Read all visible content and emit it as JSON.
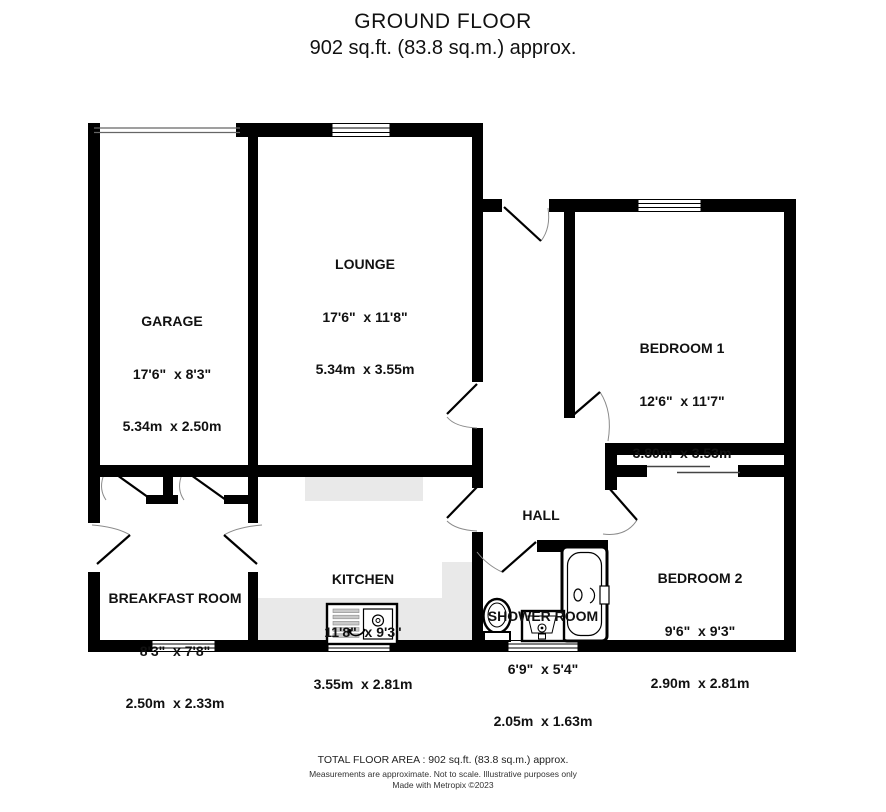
{
  "title": {
    "line1": "GROUND FLOOR",
    "line2": "902 sq.ft. (83.8 sq.m.) approx."
  },
  "rooms": [
    {
      "id": "garage",
      "name": "GARAGE",
      "imperial": "17'6\"  x 8'3\"",
      "metric": "5.34m  x 2.50m"
    },
    {
      "id": "lounge",
      "name": "LOUNGE",
      "imperial": "17'6\"  x 11'8\"",
      "metric": "5.34m  x 3.55m"
    },
    {
      "id": "bedroom-1",
      "name": "BEDROOM 1",
      "imperial": "12'6\"  x 11'7\"",
      "metric": "3.80m  x 3.53m"
    },
    {
      "id": "bedroom-2",
      "name": "BEDROOM 2",
      "imperial": "9'6\"  x 9'3\"",
      "metric": "2.90m  x 2.81m"
    },
    {
      "id": "hall",
      "name": "HALL"
    },
    {
      "id": "kitchen",
      "name": "KITCHEN",
      "imperial": "11'8\"  x 9'3\"",
      "metric": "3.55m  x 2.81m"
    },
    {
      "id": "breakfast-room",
      "name": "BREAKFAST ROOM",
      "imperial": "8'3\"  x 7'8\"",
      "metric": "2.50m  x 2.33m"
    },
    {
      "id": "shower-room",
      "name": "SHOWER ROOM",
      "imperial": "6'9\"  x 5'4\"",
      "metric": "2.05m  x 1.63m"
    }
  ],
  "footer": {
    "line1": "TOTAL FLOOR AREA : 902 sq.ft. (83.8 sq.m.) approx.",
    "line2": "Measurements are approximate.  Not to scale.  Illustrative purposes only",
    "line3": "Made with Metropix ©2023"
  },
  "colors": {
    "wall": "#000000",
    "counter": "#e9e9e9",
    "door_arc": "#8a8a8a",
    "background": "#ffffff"
  },
  "fixtures": [
    "bathtub",
    "toilet",
    "basin",
    "kitchen-sink",
    "wardrobe-doors",
    "garage-door",
    "window"
  ]
}
